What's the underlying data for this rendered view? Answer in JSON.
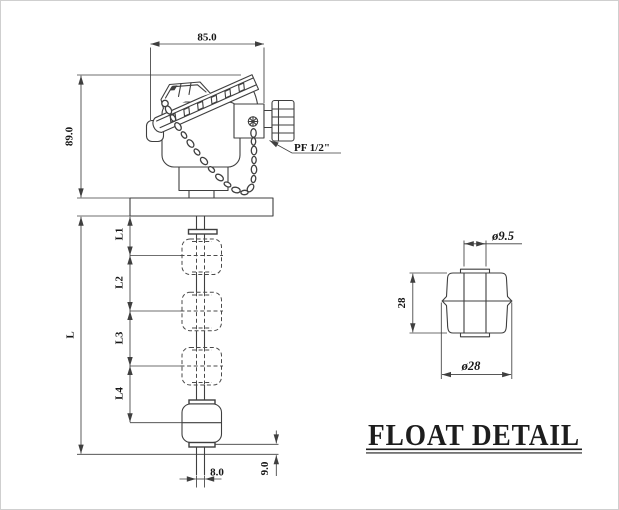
{
  "drawing_type": "float level switch assembly drawing",
  "colors": {
    "line": "#3f3f3f",
    "text": "#161616",
    "background": "#ffffff"
  },
  "main_view": {
    "head_width": "85.0",
    "head_height": "89.0",
    "connection_label": "PF 1/2\"",
    "overall_length": "L",
    "float_levels": [
      "L1",
      "L2",
      "L3",
      "L4"
    ],
    "stem_diameter": "8.0",
    "tip_length": "9.0"
  },
  "float_detail": {
    "title": "FLOAT DETAIL",
    "hole_diameter": "ø9.5",
    "height": "28",
    "outer_diameter": "ø28"
  }
}
